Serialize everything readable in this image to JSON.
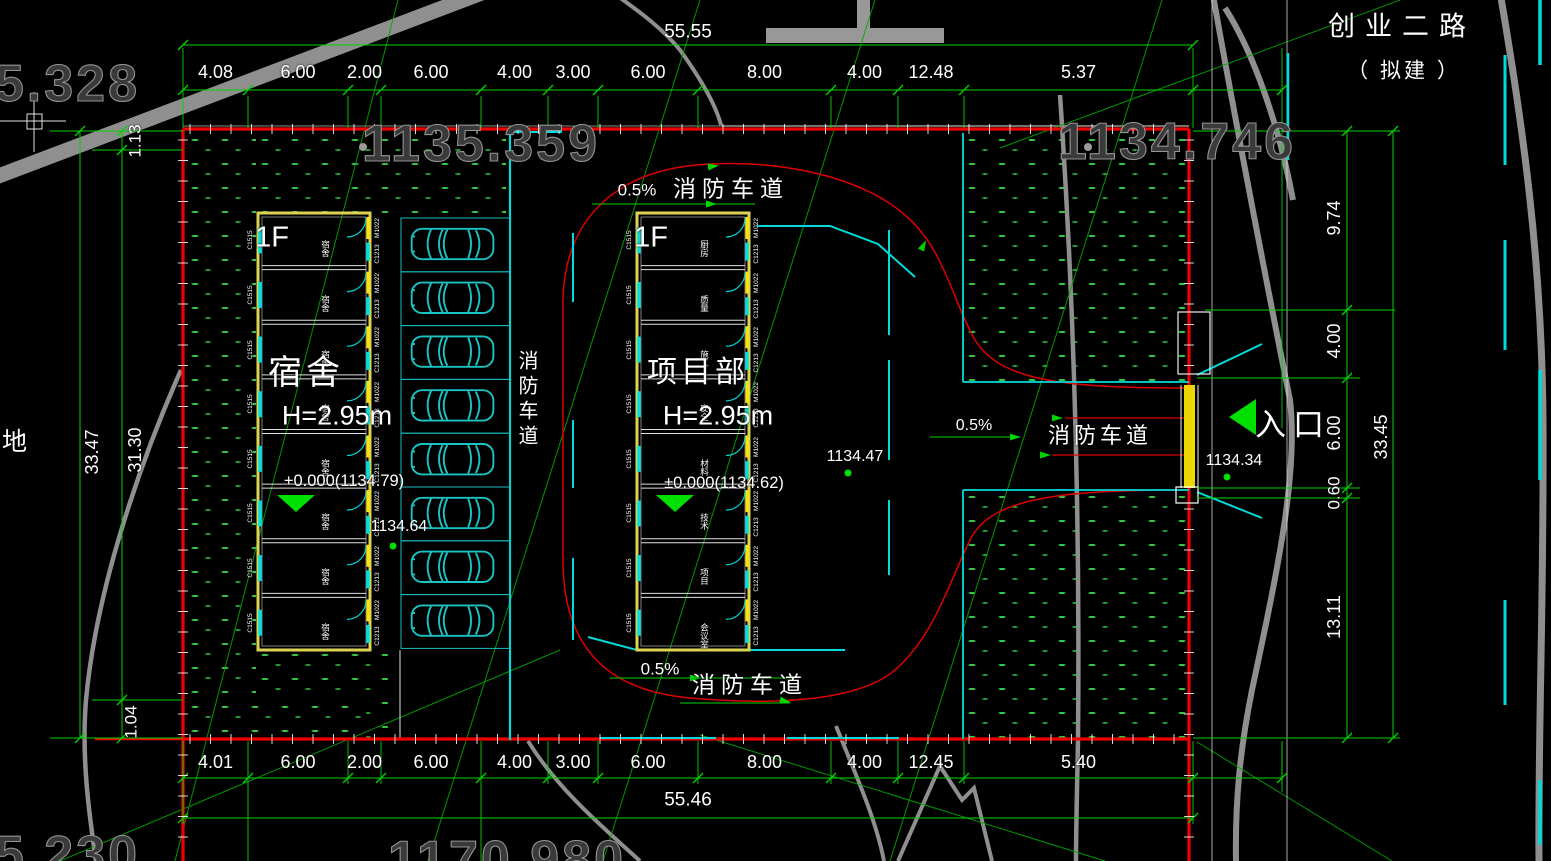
{
  "road": {
    "name": "创业二路",
    "status": "（ 拟建 ）"
  },
  "entrance": {
    "label": "入口",
    "spot_elevation": "1134.34"
  },
  "fire_lane": {
    "label": "消防车道",
    "slope": "0.5%"
  },
  "spots": {
    "courtyard": "1134.47",
    "parking_side": "1134.64"
  },
  "survey": {
    "top_left": "1135.328",
    "top_center": "1135.359",
    "top_right": "1134.746",
    "bottom_left": "1135.230",
    "bottom_center": "1170.980"
  },
  "misc": {
    "partial_label": "地"
  },
  "dims": {
    "top_total": "55.55",
    "bottom_total": "55.46",
    "left_total": "33.47",
    "right_total": "33.45",
    "top": [
      "4.08",
      "6.00",
      "2.00",
      "6.00",
      "4.00",
      "3.00",
      "6.00",
      "8.00",
      "4.00",
      "12.48",
      "5.37"
    ],
    "bottom": [
      "4.01",
      "6.00",
      "2.00",
      "6.00",
      "4.00",
      "3.00",
      "6.00",
      "8.00",
      "4.00",
      "12.45",
      "5.40"
    ],
    "left": [
      "1.13",
      "31.30",
      "1.04"
    ],
    "right": [
      "9.74",
      "4.00",
      "6.00",
      "0.60",
      "13.11"
    ]
  },
  "buildings": [
    {
      "floor": "1F",
      "name": "宿舍",
      "height": "H=2.95m",
      "level": "+0.000(1134.79)",
      "window_code": "C1515",
      "door_code": "M1022",
      "window2_code": "C1213",
      "rooms": [
        "宿舍",
        "宿舍",
        "宿舍",
        "宿舍",
        "宿舍",
        "宿舍",
        "宿舍",
        "宿舍"
      ]
    },
    {
      "floor": "1F",
      "name": "项目部",
      "height": "H=2.95m",
      "level": "±0.000(1134.62)",
      "window_code": "C1515",
      "door_code": "M1022",
      "window2_code": "C1213",
      "rooms": [
        "厨房",
        "质量",
        "施工",
        "安全",
        "材料",
        "技术",
        "项目",
        "会议室"
      ]
    }
  ],
  "parking": {
    "stalls": 8
  }
}
